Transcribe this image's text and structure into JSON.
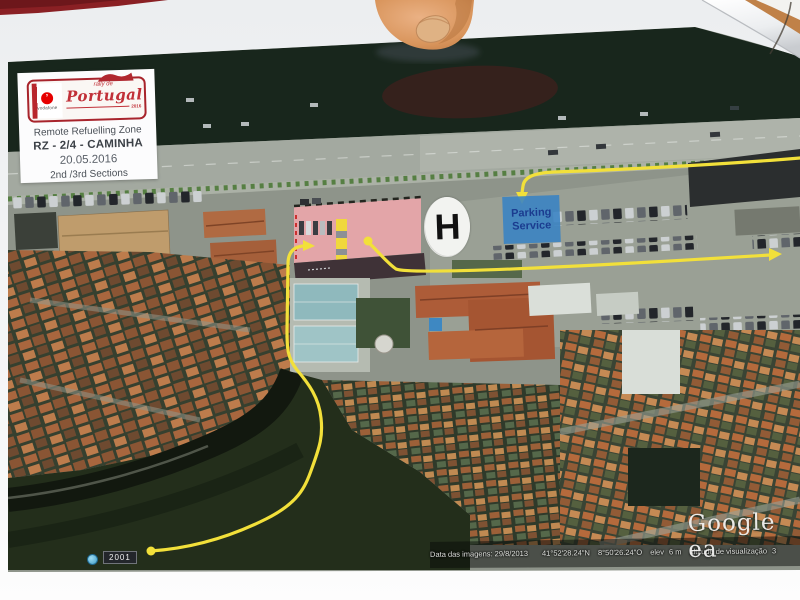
{
  "photo": {
    "description": "hand-held printed rally map photo",
    "year_badge": "2001"
  },
  "info_box": {
    "logo": {
      "sponsor": "vodafone",
      "sponsor_mark": "’",
      "series_small": "rally de",
      "series_main": "Portugal",
      "edition_year": "2016"
    },
    "title": "Remote Refuelling Zone",
    "zone_code": "RZ - 2/4 - CAMINHA",
    "date": "20.05.2016",
    "sections": "2nd /3rd Sections"
  },
  "map": {
    "helipad": "H",
    "parking": {
      "line1": "Parking",
      "line2": "Service"
    },
    "watermark": "Google ea",
    "footer": {
      "imagery_date": "Data das imagens: 29/8/2013",
      "latitude": "41°52'28.24\"N",
      "longitude": "8°50'26.24\"O",
      "elevation_label": "elev",
      "elevation_value": "6 m",
      "view_altitude_label": "altitude de visualização",
      "view_altitude_value": "3"
    },
    "colors": {
      "route": "#f2e03a",
      "refuel_zone": "#eba6aa",
      "parking_box": "#3f86c5",
      "helipad_circle": "#f2f3f0"
    }
  }
}
